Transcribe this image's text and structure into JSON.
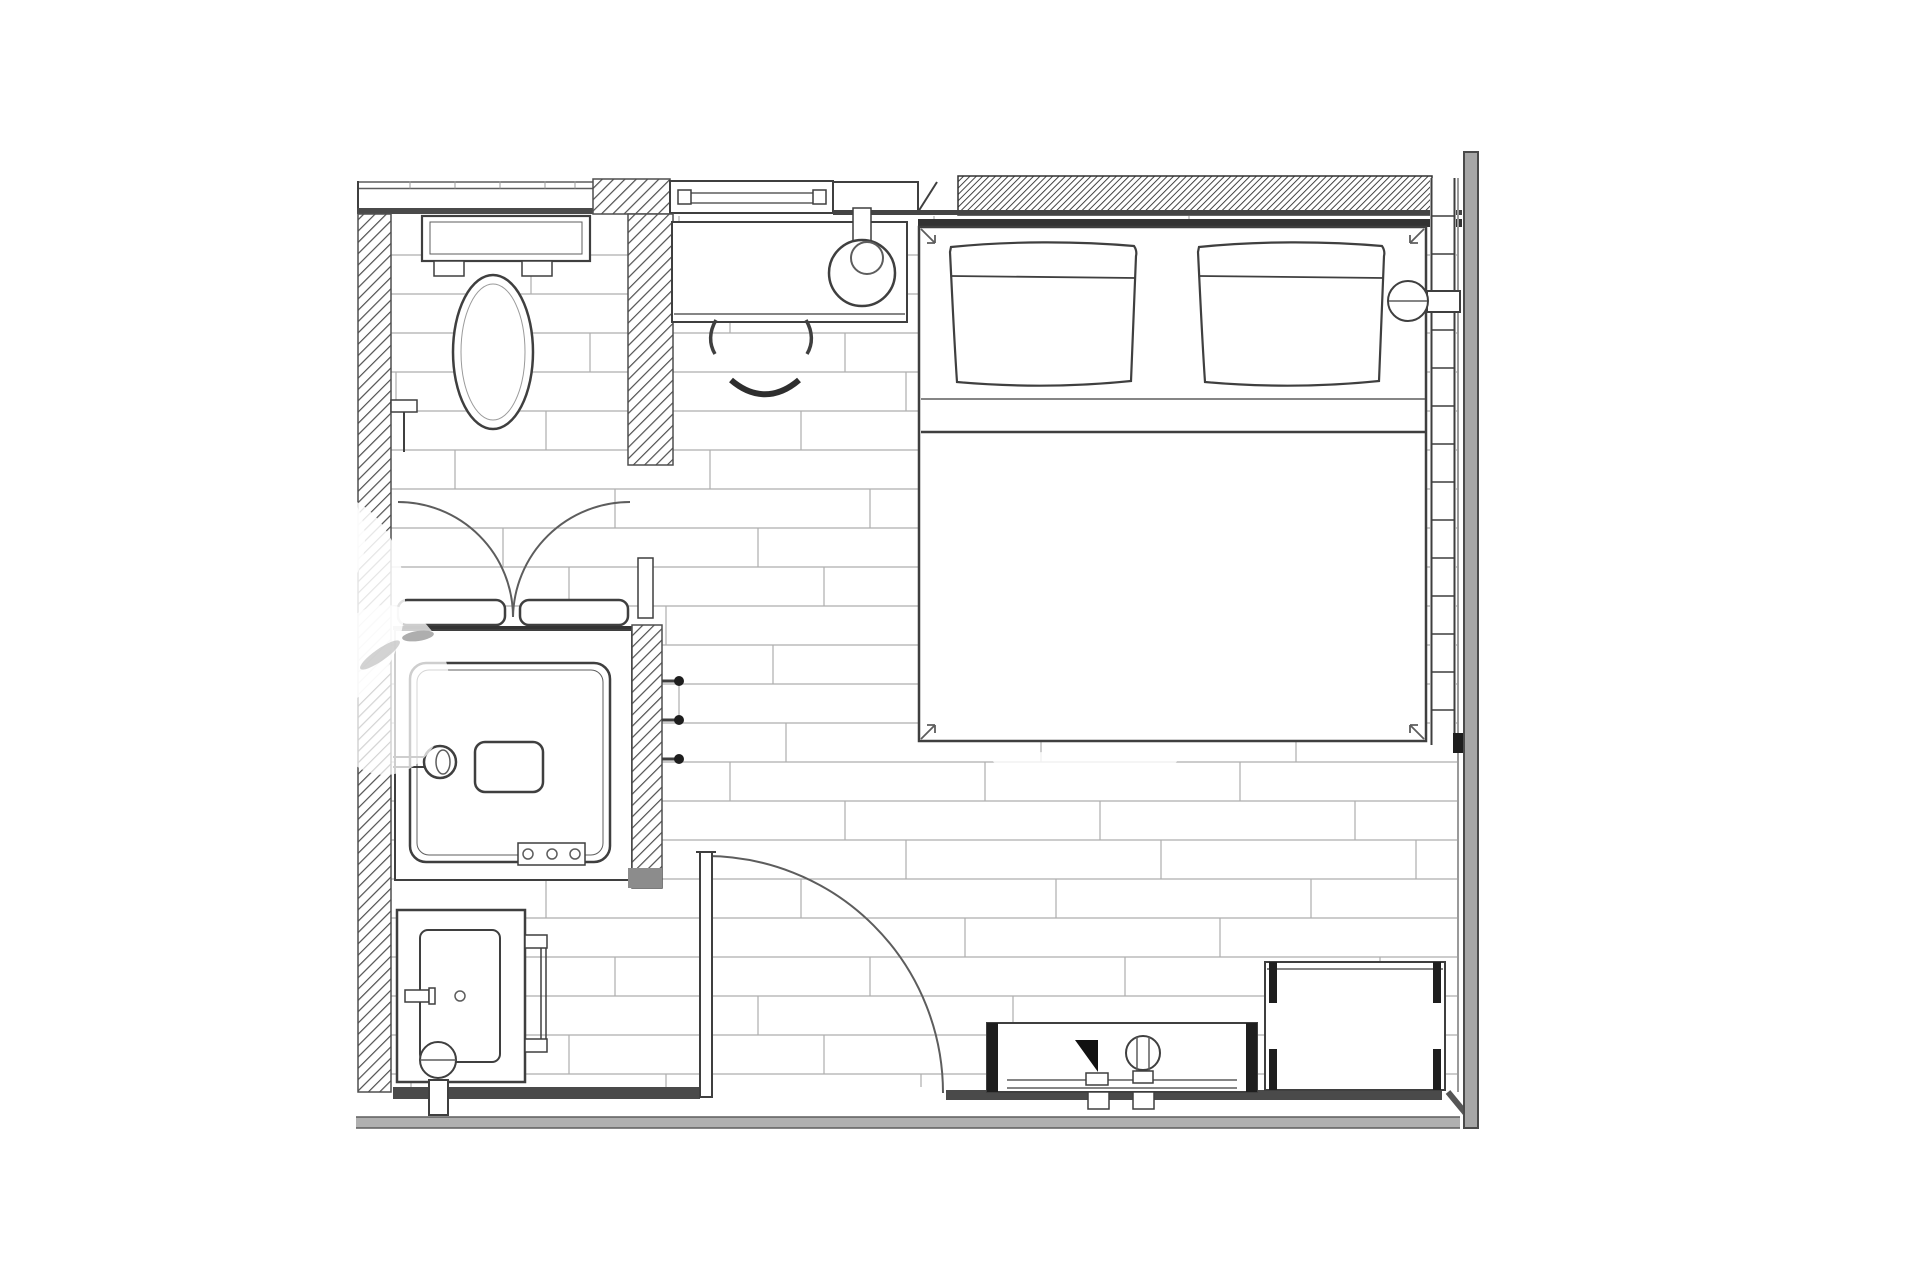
{
  "meta": {
    "type": "architectural-floor-plan",
    "subject": "hotel-guest-room-with-open-bathroom",
    "background": "#ffffff",
    "has_text_labels": false
  },
  "colors": {
    "line": "#3f3f3f",
    "soft": "#5d5d5d",
    "faint": "#9a9a9a",
    "black": "#1e1e1e",
    "band": "#4a4a4a",
    "gray_band": "#b0b0b0",
    "right_wall": "#a6a6a6",
    "hatch": "#4f4f4f",
    "hatch_dense": "#303030",
    "plank": "#aeaeae",
    "background": "#ffffff"
  },
  "floor": {
    "x": 391,
    "y": 214,
    "x2": 1457,
    "y2": 1087,
    "row_height": 39,
    "joint_period": 255,
    "joint_offsets": [
      33,
      140,
      84,
      199,
      5,
      155,
      64,
      224,
      112,
      178,
      20,
      127
    ]
  },
  "window_strip": {
    "x": 1430,
    "x2": 1456,
    "y": 178,
    "y2": 745,
    "rung_step": 38
  },
  "siding_ticks": {
    "xs": [
      410,
      455,
      500,
      545,
      575
    ],
    "y1": 181.5,
    "y2": 188.5
  },
  "shower": {
    "hooks_y": [
      681,
      720,
      759
    ],
    "hook_x1": 662,
    "hook_x2": 676,
    "control_xs": [
      528,
      552,
      575
    ],
    "control_y": 854
  },
  "watermarks": [
    {
      "kind": "blob",
      "cx": 330,
      "cy": 600,
      "rx": 75,
      "ry": 105,
      "opacity": 0.85
    },
    {
      "kind": "blob",
      "cx": 385,
      "cy": 690,
      "rx": 65,
      "ry": 85,
      "opacity": 0.75
    },
    {
      "kind": "blob",
      "cx": 310,
      "cy": 540,
      "rx": 55,
      "ry": 65,
      "opacity": 0.8
    },
    {
      "kind": "streak",
      "cx": 1085,
      "cy": 761,
      "rx": 92,
      "ry": 10,
      "opacity": 0.8
    },
    {
      "kind": "smudge",
      "cx": 418,
      "cy": 636,
      "rx": 16,
      "ry": 5,
      "opacity": 0.8,
      "color": "#9a9a9a",
      "rot": -8
    },
    {
      "kind": "smudge",
      "cx": 380,
      "cy": 655,
      "rx": 24,
      "ry": 6,
      "opacity": 0.6,
      "color": "#b5b5b5",
      "rot": -35
    }
  ],
  "fixtures": [
    "toilet",
    "toilet-paper-holder",
    "shower-enclosure",
    "shower-double-doors",
    "shower-head",
    "shower-niche",
    "shower-controls",
    "robe-hooks",
    "glass-partition",
    "vanity-counter",
    "vanity-sink",
    "vanity-faucet",
    "towel-bar",
    "entry-door",
    "double-bed",
    "pillow-left",
    "pillow-right",
    "bedside-lamp-left",
    "bedside-sconce-right",
    "desk",
    "desk-chair",
    "window-wall-mullions",
    "tv-console",
    "decor-triangle",
    "decor-vase",
    "luggage-bench"
  ]
}
